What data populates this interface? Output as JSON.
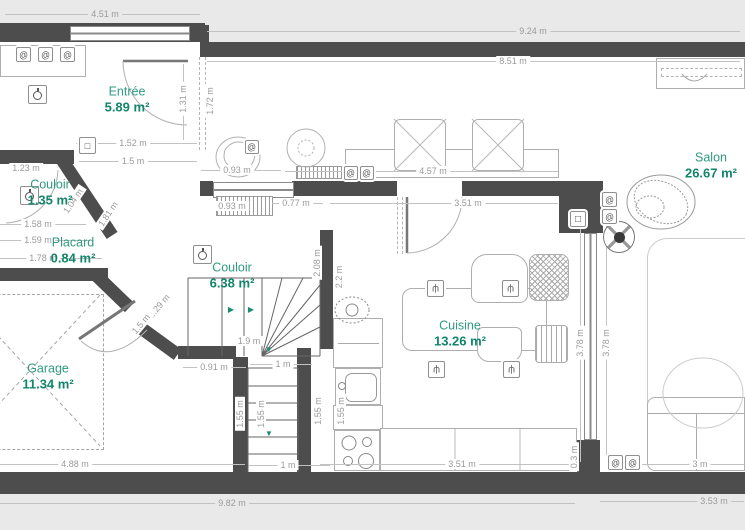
{
  "plan": {
    "type": "floor-plan",
    "units": "m"
  },
  "colors": {
    "background": "#e9e9e9",
    "floor": "#ffffff",
    "wall": "#4d4d4d",
    "room_name": "#2f9a80",
    "room_area": "#12866b",
    "dimension_text": "#9a9a9a",
    "stair_arrow": "#1f8a70"
  },
  "rooms": [
    {
      "id": "entree",
      "name": "Entrée",
      "area": "5.89 m²",
      "x": 127,
      "y": 100
    },
    {
      "id": "salon",
      "name": "Salon",
      "area": "26.67 m²",
      "x": 711,
      "y": 166
    },
    {
      "id": "couloir1",
      "name": "Couloir",
      "area": "1.35 m²",
      "x": 50,
      "y": 193
    },
    {
      "id": "placard",
      "name": "Placard",
      "area": "0.84 m²",
      "x": 73,
      "y": 251
    },
    {
      "id": "couloir2",
      "name": "Couloir",
      "area": "6.38 m²",
      "x": 232,
      "y": 276
    },
    {
      "id": "garage",
      "name": "Garage",
      "area": "11.34 m²",
      "x": 48,
      "y": 377
    },
    {
      "id": "cuisine",
      "name": "Cuisine",
      "area": "13.26 m²",
      "x": 460,
      "y": 334
    }
  ],
  "dimensions": [
    {
      "t": "4.51 m",
      "x": 105,
      "y": 14,
      "bg": "g",
      "line": [
        5,
        14,
        200,
        14
      ]
    },
    {
      "t": "9.24 m",
      "x": 533,
      "y": 31,
      "bg": "g",
      "line": [
        207,
        31,
        740,
        31
      ]
    },
    {
      "t": "8.51 m",
      "x": 513,
      "y": 61,
      "line": [
        207,
        61,
        740,
        61
      ]
    },
    {
      "t": "1.31 m",
      "x": 183,
      "y": 99,
      "r": -90,
      "line": [
        183,
        64,
        183,
        140
      ]
    },
    {
      "t": "1.72 m",
      "x": 210,
      "y": 101,
      "r": -90
    },
    {
      "t": "1.52 m",
      "x": 133,
      "y": 143,
      "line": [
        76,
        143,
        197,
        143
      ]
    },
    {
      "t": "1.5 m",
      "x": 133,
      "y": 161,
      "line": [
        79,
        161,
        197,
        161
      ]
    },
    {
      "t": "0.93 m",
      "x": 237,
      "y": 170,
      "line": [
        201,
        170,
        281,
        170
      ]
    },
    {
      "t": "4.57 m",
      "x": 433,
      "y": 171,
      "line": [
        285,
        171,
        558,
        171
      ]
    },
    {
      "t": "0.93 m",
      "x": 232,
      "y": 206
    },
    {
      "t": "0.77 m",
      "x": 296,
      "y": 203,
      "line": [
        272,
        203,
        323,
        203
      ]
    },
    {
      "t": "3.51 m",
      "x": 468,
      "y": 203,
      "line": [
        330,
        203,
        558,
        203
      ]
    },
    {
      "t": "1.23 m",
      "x": 26,
      "y": 168
    },
    {
      "t": "1.58 m",
      "x": 38,
      "y": 224,
      "line": [
        0,
        224,
        86,
        224
      ]
    },
    {
      "t": "1.59 m",
      "x": 38,
      "y": 240,
      "line": [
        0,
        240,
        90,
        240
      ]
    },
    {
      "t": "1.78 m",
      "x": 43,
      "y": 258,
      "line": [
        0,
        258,
        102,
        258
      ]
    },
    {
      "t": "1.04 m",
      "x": 73,
      "y": 201,
      "r": -56
    },
    {
      "t": "1.81 m",
      "x": 108,
      "y": 214,
      "r": -56
    },
    {
      "t": "2.08 m",
      "x": 317,
      "y": 263,
      "r": -90
    },
    {
      "t": "2.2 m",
      "x": 339,
      "y": 277,
      "r": -90
    },
    {
      "t": "1.9 m",
      "x": 249,
      "y": 341
    },
    {
      "t": "1.29 m",
      "x": 159,
      "y": 306,
      "r": -50
    },
    {
      "t": "1.5 m",
      "x": 141,
      "y": 324,
      "r": -50
    },
    {
      "t": "0.91 m",
      "x": 214,
      "y": 367,
      "line": [
        183,
        367,
        246,
        367
      ]
    },
    {
      "t": "1 m",
      "x": 283,
      "y": 364,
      "line": [
        250,
        364,
        312,
        364
      ]
    },
    {
      "t": "1.55 m",
      "x": 240,
      "y": 414,
      "r": -90
    },
    {
      "t": "1.55 m",
      "x": 261,
      "y": 414,
      "r": -90
    },
    {
      "t": "1.55 m",
      "x": 318,
      "y": 411,
      "r": -90
    },
    {
      "t": "1.55 m",
      "x": 341,
      "y": 411,
      "r": -90
    },
    {
      "t": "3.78 m",
      "x": 580,
      "y": 343,
      "r": -90,
      "line": [
        580,
        210,
        580,
        462
      ]
    },
    {
      "t": "3.78 m",
      "x": 606,
      "y": 343,
      "r": -90,
      "line": [
        606,
        215,
        606,
        462
      ]
    },
    {
      "t": "0.3 m",
      "x": 574,
      "y": 457,
      "r": -90
    },
    {
      "t": "1 m",
      "x": 288,
      "y": 465,
      "line": [
        249,
        465,
        330,
        465
      ]
    },
    {
      "t": "3.51 m",
      "x": 462,
      "y": 464,
      "line": [
        320,
        464,
        575,
        464
      ]
    },
    {
      "t": "3 m",
      "x": 700,
      "y": 464,
      "line": [
        610,
        464,
        744,
        464
      ]
    },
    {
      "t": "4.88 m",
      "x": 75,
      "y": 464,
      "line": [
        0,
        464,
        245,
        464
      ]
    },
    {
      "t": "9.82 m",
      "x": 232,
      "y": 503,
      "bg": "g",
      "line": [
        0,
        503,
        575,
        503
      ]
    },
    {
      "t": "3.53 m",
      "x": 714,
      "y": 501,
      "bg": "g",
      "line": [
        600,
        501,
        744,
        501
      ]
    }
  ],
  "icons": [
    {
      "type": "wall-switch",
      "x": 16,
      "y": 47,
      "s": 15
    },
    {
      "type": "wall-switch",
      "x": 38,
      "y": 47,
      "s": 15
    },
    {
      "type": "wall-switch",
      "x": 60,
      "y": 47,
      "s": 15
    },
    {
      "type": "pendant-light",
      "x": 28,
      "y": 85,
      "s": 19
    },
    {
      "type": "pendant-light",
      "x": 20,
      "y": 186,
      "s": 19
    },
    {
      "type": "pendant-light",
      "x": 193,
      "y": 245,
      "s": 19
    },
    {
      "type": "wall-control",
      "x": 79,
      "y": 137,
      "s": 17
    },
    {
      "type": "wall-switch",
      "x": 245,
      "y": 140,
      "s": 14
    },
    {
      "type": "wall-sconce",
      "x": 344,
      "y": 166,
      "s": 14
    },
    {
      "type": "wall-sconce",
      "x": 360,
      "y": 166,
      "s": 14
    },
    {
      "type": "tv-outlet",
      "x": 570,
      "y": 211,
      "s": 16
    },
    {
      "type": "wall-sconce",
      "x": 602,
      "y": 192,
      "s": 15
    },
    {
      "type": "wall-sconce",
      "x": 602,
      "y": 209,
      "s": 15
    },
    {
      "type": "ceiling-fan",
      "x": 603,
      "y": 221,
      "s": 32
    },
    {
      "type": "wall-sconce",
      "x": 608,
      "y": 455,
      "s": 15
    },
    {
      "type": "wall-sconce",
      "x": 625,
      "y": 455,
      "s": 15
    },
    {
      "type": "spotlight",
      "x": 427,
      "y": 280,
      "s": 17
    },
    {
      "type": "spotlight",
      "x": 502,
      "y": 280,
      "s": 17
    },
    {
      "type": "spotlight",
      "x": 428,
      "y": 361,
      "s": 17
    },
    {
      "type": "spotlight",
      "x": 503,
      "y": 361,
      "s": 17
    },
    {
      "type": "arrow-right",
      "x": 226,
      "y": 304,
      "s": 10
    },
    {
      "type": "arrow-right",
      "x": 246,
      "y": 304,
      "s": 10
    },
    {
      "type": "arrow-down",
      "x": 264,
      "y": 344,
      "s": 10
    },
    {
      "type": "arrow-down",
      "x": 264,
      "y": 428,
      "s": 10
    }
  ]
}
